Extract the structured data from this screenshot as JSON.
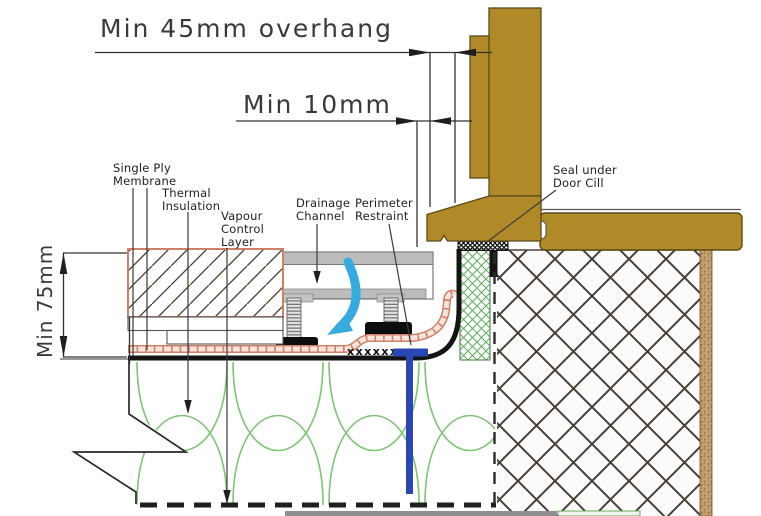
{
  "drawing": {
    "type": "construction-detail",
    "subject": "Level threshold door cill / flat roof terrace drainage detail"
  },
  "dimensions": {
    "overhang": "Min 45mm overhang",
    "gap": "Min 10mm",
    "upstand": "Min 75mm"
  },
  "labels": {
    "single_ply": [
      "Single Ply",
      "Membrane"
    ],
    "thermal": [
      "Thermal",
      "Insulation"
    ],
    "vcl": [
      "Vapour",
      "Control",
      "Layer"
    ],
    "drainage": [
      "Drainage",
      "Channel"
    ],
    "perimeter": [
      "Perimeter",
      "Restraint"
    ],
    "seal": [
      "Seal under",
      "Door Cill"
    ],
    "fixing_marks": "xxxxxx"
  },
  "colors": {
    "wood": "#b08928",
    "wood_outline": "#5a4a18",
    "membrane_black": "#141414",
    "underlay_salmon": "#cf8168",
    "underlay_fill": "#f8e4db",
    "insulation_green": "#7cc573",
    "upstand_green": "#5fae5c",
    "water_arrow_cyan": "#35abe0",
    "restraint_blue": "#2b47b5",
    "channel_gray": "#bcbcbc",
    "wall_hatch": "#4a4440",
    "plaster_speckle": "#c8a06f"
  }
}
